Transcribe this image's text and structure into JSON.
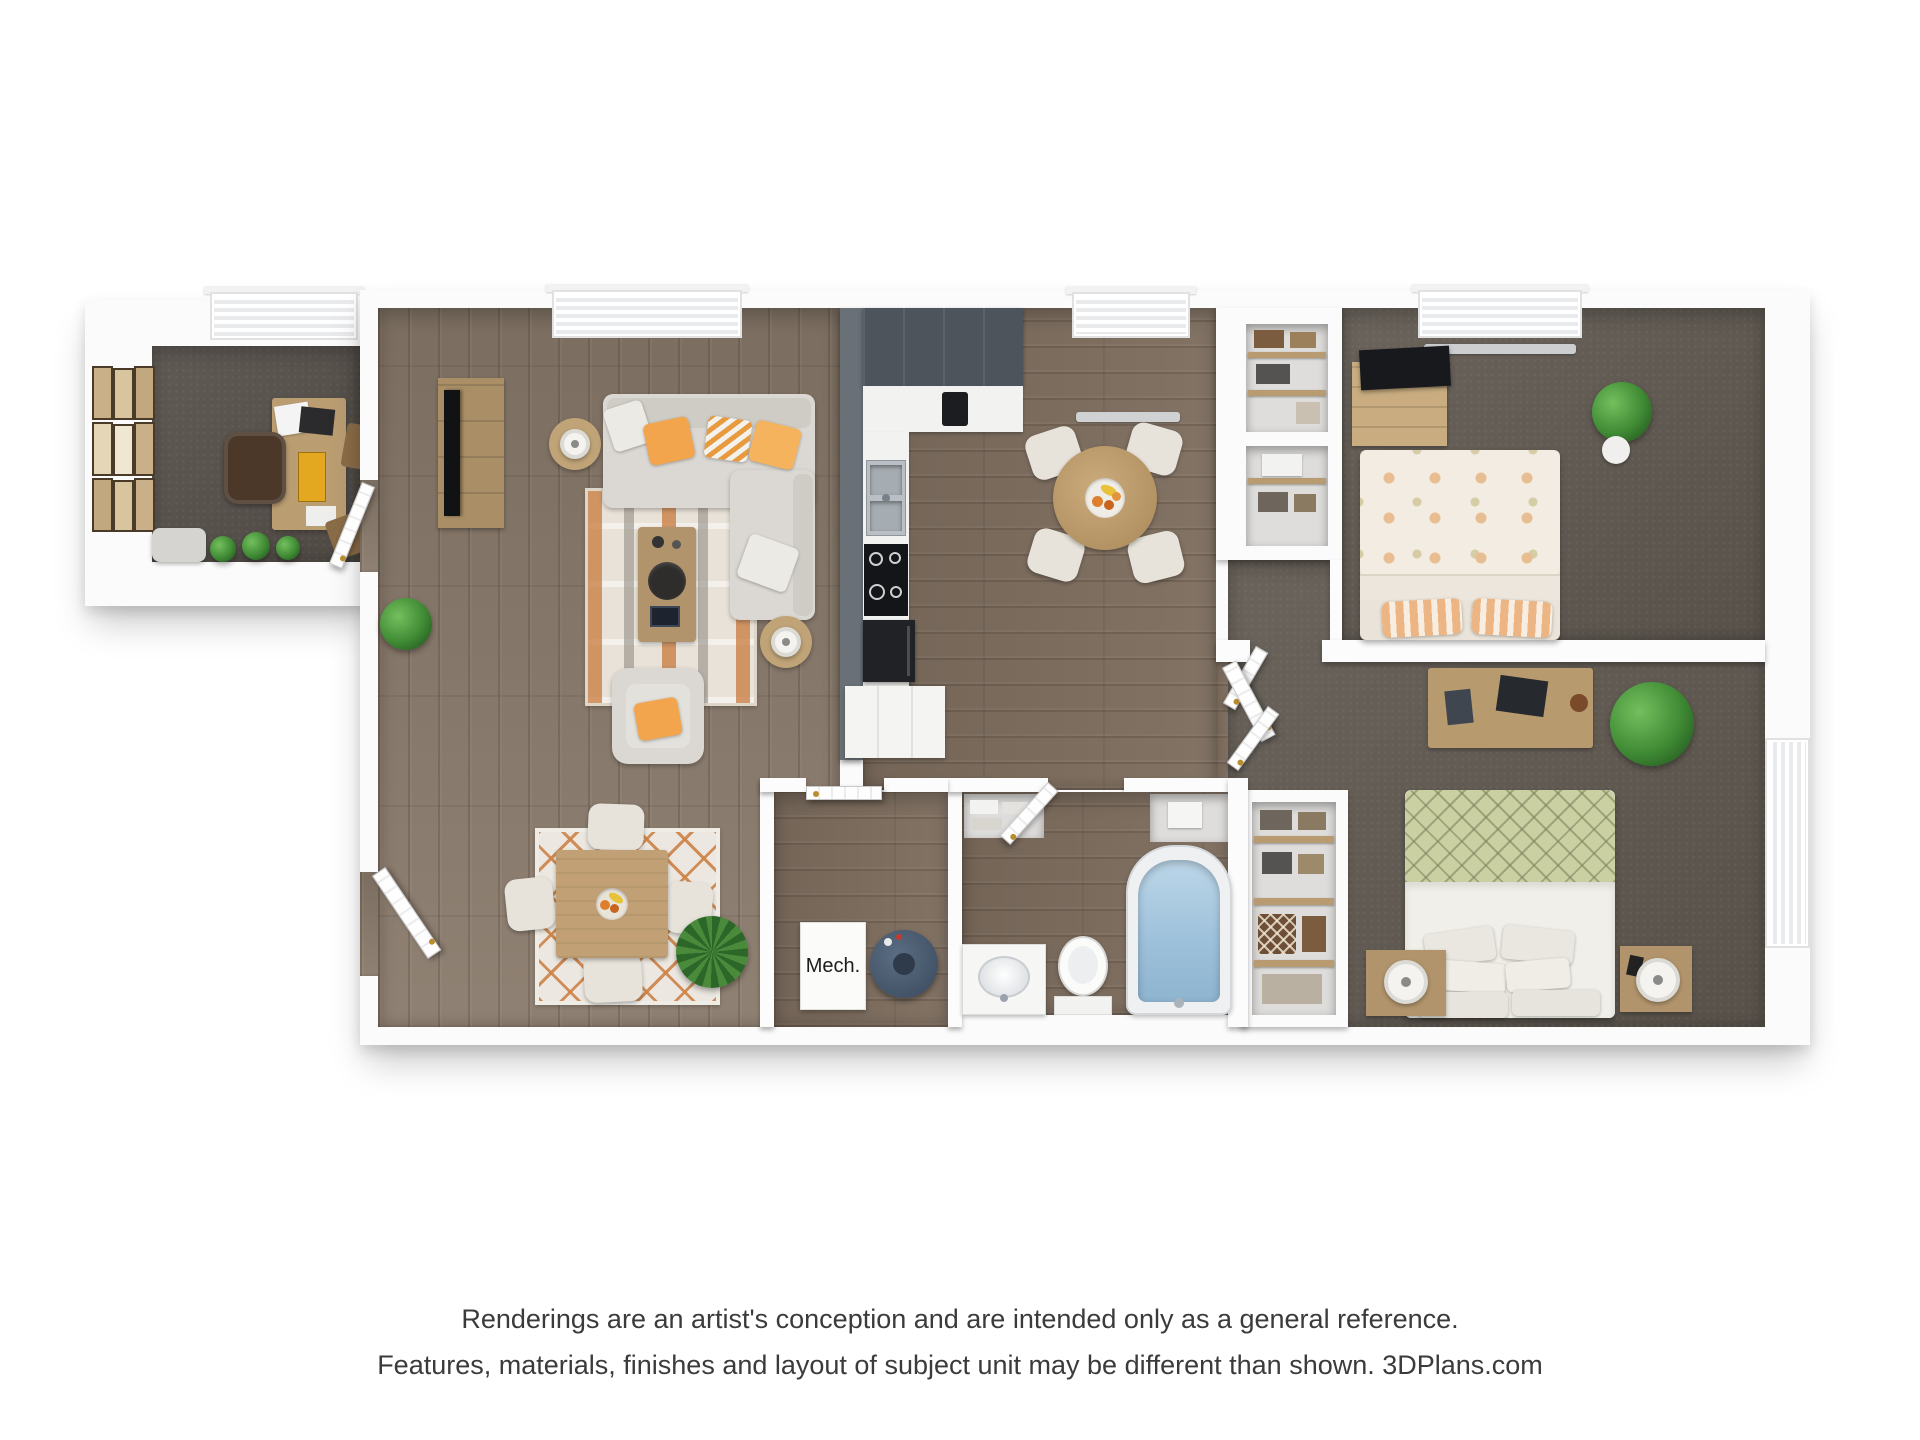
{
  "page": {
    "background_color": "#ffffff"
  },
  "floorplan": {
    "type": "3d-floor-plan-rendering",
    "labels": {
      "mech": "Mech."
    },
    "rooms": [
      "office",
      "living-room",
      "dining-area",
      "kitchen",
      "breakfast-nook",
      "hallway",
      "bathroom",
      "mechanical-closet",
      "bedroom-1",
      "bedroom-2",
      "closets"
    ],
    "palette": {
      "wall_white": "#fbfbfb",
      "wood_floor_living": "#897a6b",
      "wood_floor_kitchen": "#7d6d5e",
      "carpet": "#615a52",
      "kitchen_cabinet_dark": "#4d545c",
      "accent_wall_gray": "#697077",
      "counter_white": "#f2f2f0",
      "appliance_black": "#1a1c1f",
      "sofa_gray": "#dbd8d3",
      "pillow_orange": "#f2a54d",
      "rug_cream": "#e8e2d8",
      "rug_orange": "#c8793c",
      "wood_furniture": "#b79a6e",
      "bed_green": "#cad0a2",
      "bed_floral": "#f3ece2",
      "tub_water": "#a2c4dc",
      "water_heater_blue": "#4a5a6c",
      "plant_green": "#3f8a34",
      "door_knob_gold": "#b98c2f"
    }
  },
  "footer": {
    "line1": "Renderings are an artist's conception and are intended only as a general reference.",
    "line2": "Features, materials, finishes and layout of subject unit may be different than shown. 3DPlans.com"
  }
}
